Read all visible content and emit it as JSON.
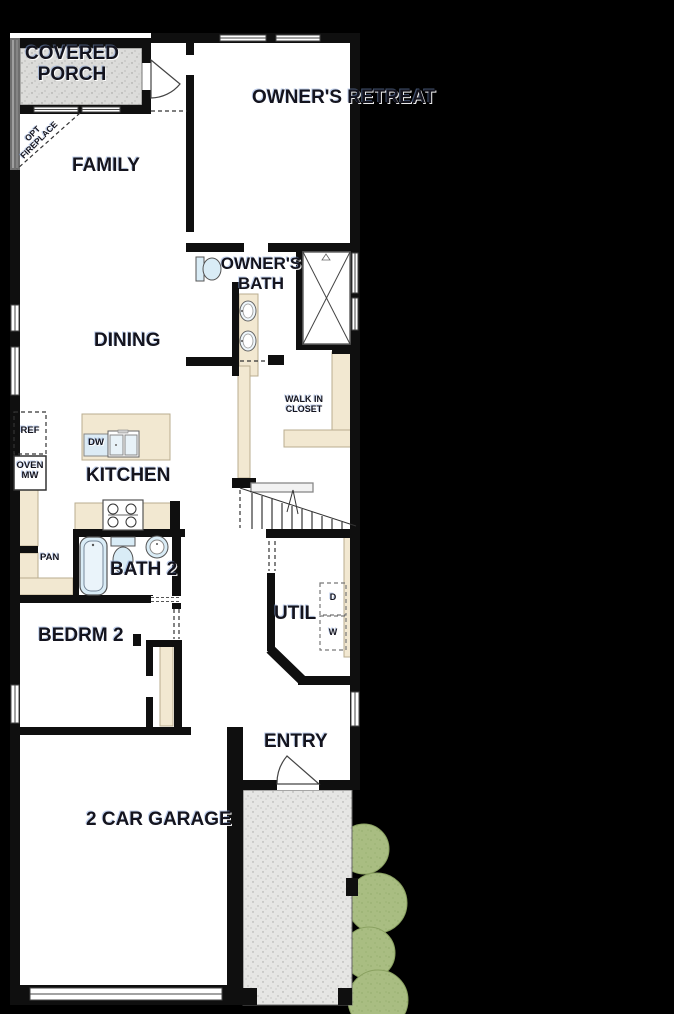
{
  "title": "Single-family home first floor plan",
  "colors": {
    "background": "#000000",
    "floor": "#ffffff",
    "wall": "#0f0f0f",
    "cabinet_cream": "#f2e8d1",
    "fixture_blue": "#d9ecf6",
    "porch_concrete": "#dcdcda",
    "walkway_concrete": "#e6e6e4",
    "bush_green": "#a9bd82"
  },
  "rooms": {
    "covered_porch": {
      "label": "COVERED PORCH"
    },
    "owners_retreat": {
      "label": "OWNER'S RETREAT"
    },
    "family": {
      "label": "FAMILY"
    },
    "owners_bath": {
      "label": "OWNER'S BATH"
    },
    "dining": {
      "label": "DINING"
    },
    "walk_in_closet": {
      "label": "WALK IN CLOSET"
    },
    "kitchen": {
      "label": "KITCHEN"
    },
    "bath_2": {
      "label": "BATH 2"
    },
    "bedroom_2": {
      "label": "BEDRM 2"
    },
    "utility": {
      "label": "UTIL"
    },
    "entry": {
      "label": "ENTRY"
    },
    "garage": {
      "label": "2 CAR GARAGE"
    },
    "pantry": {
      "label": "PAN"
    }
  },
  "annotations": {
    "opt_fireplace": "OPT FIREPLACE"
  },
  "appliances": {
    "refrigerator": "REF",
    "oven": "OVEN",
    "microwave": "MW",
    "dishwasher": "DW",
    "dryer": "D",
    "washer": "W"
  }
}
